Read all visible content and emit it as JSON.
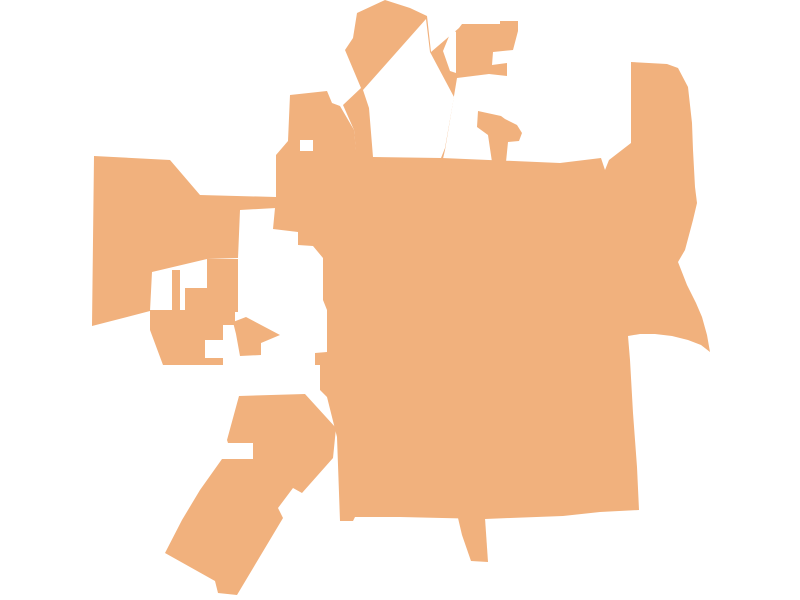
{
  "map": {
    "title": "municipality-boundary-silhouette",
    "background_color": "#ffffff",
    "region_color": "#F1B17D",
    "cutout_color": "#ffffff",
    "width": 800,
    "height": 600,
    "regions": [
      {
        "name": "main-body",
        "points": [
          [
            290,
            95
          ],
          [
            327,
            91
          ],
          [
            332,
            103
          ],
          [
            340,
            106
          ],
          [
            354,
            130
          ],
          [
            356,
            150
          ],
          [
            380,
            158
          ],
          [
            412,
            161
          ],
          [
            442,
            158
          ],
          [
            560,
            163
          ],
          [
            601,
            158
          ],
          [
            605,
            170
          ],
          [
            609,
            160
          ],
          [
            631,
            143
          ],
          [
            631,
            62
          ],
          [
            667,
            64
          ],
          [
            678,
            68
          ],
          [
            688,
            87
          ],
          [
            692,
            123
          ],
          [
            693,
            150
          ],
          [
            695,
            187
          ],
          [
            697,
            203
          ],
          [
            693,
            220
          ],
          [
            685,
            250
          ],
          [
            678,
            262
          ],
          [
            687,
            285
          ],
          [
            696,
            303
          ],
          [
            702,
            317
          ],
          [
            707,
            335
          ],
          [
            710,
            352
          ],
          [
            701,
            345
          ],
          [
            688,
            340
          ],
          [
            672,
            336
          ],
          [
            655,
            334
          ],
          [
            640,
            334
          ],
          [
            628,
            336
          ],
          [
            630,
            360
          ],
          [
            633,
            413
          ],
          [
            637,
            467
          ],
          [
            639,
            510
          ],
          [
            600,
            512
          ],
          [
            563,
            516
          ],
          [
            510,
            518
          ],
          [
            485,
            519
          ],
          [
            400,
            517
          ],
          [
            355,
            517
          ],
          [
            353,
            521
          ],
          [
            340,
            521
          ],
          [
            337,
            437
          ],
          [
            335,
            429
          ],
          [
            327,
            397
          ],
          [
            320,
            390
          ],
          [
            320,
            365
          ],
          [
            315,
            365
          ],
          [
            315,
            353
          ],
          [
            327,
            352
          ],
          [
            327,
            310
          ],
          [
            323,
            300
          ],
          [
            323,
            258
          ],
          [
            313,
            246
          ],
          [
            298,
            245
          ],
          [
            298,
            232
          ],
          [
            273,
            229
          ],
          [
            275,
            208
          ],
          [
            276,
            197
          ],
          [
            276,
            155
          ],
          [
            288,
            141
          ]
        ]
      },
      {
        "name": "north-lobe-assembly",
        "points": [
          [
            345,
            50
          ],
          [
            353,
            38
          ],
          [
            357,
            13
          ],
          [
            385,
            0
          ],
          [
            410,
            8
          ],
          [
            427,
            16
          ],
          [
            431,
            52
          ],
          [
            459,
            28
          ],
          [
            462,
            24
          ],
          [
            500,
            24
          ],
          [
            500,
            21
          ],
          [
            518,
            21
          ],
          [
            518,
            31
          ],
          [
            513,
            50
          ],
          [
            493,
            52
          ],
          [
            492,
            65
          ],
          [
            507,
            63
          ],
          [
            507,
            76
          ],
          [
            489,
            74
          ],
          [
            457,
            78
          ],
          [
            445,
            150
          ],
          [
            442,
            163
          ],
          [
            412,
            163
          ],
          [
            370,
            160
          ],
          [
            356,
            152
          ],
          [
            354,
            130
          ],
          [
            343,
            105
          ],
          [
            361,
            88
          ]
        ]
      },
      {
        "name": "flag-piece",
        "points": [
          [
            478,
            111
          ],
          [
            501,
            116
          ],
          [
            505,
            119
          ],
          [
            517,
            125
          ],
          [
            522,
            133
          ],
          [
            519,
            141
          ],
          [
            508,
            142
          ],
          [
            506,
            162
          ],
          [
            492,
            162
          ],
          [
            488,
            135
          ],
          [
            477,
            127
          ]
        ]
      },
      {
        "name": "west-lobe",
        "points": [
          [
            94,
            156
          ],
          [
            170,
            160
          ],
          [
            200,
            195
          ],
          [
            276,
            197
          ],
          [
            276,
            208
          ],
          [
            240,
            210
          ],
          [
            238,
            258
          ],
          [
            207,
            259
          ],
          [
            152,
            272
          ],
          [
            150,
            311
          ],
          [
            92,
            326
          ]
        ]
      },
      {
        "name": "west-column-a",
        "points": [
          [
            172,
            270
          ],
          [
            180,
            270
          ],
          [
            180,
            312
          ],
          [
            172,
            312
          ]
        ]
      },
      {
        "name": "west-column-b",
        "points": [
          [
            185,
            288
          ],
          [
            207,
            288
          ],
          [
            207,
            312
          ],
          [
            185,
            312
          ]
        ]
      },
      {
        "name": "west-column-c",
        "points": [
          [
            207,
            259
          ],
          [
            238,
            259
          ],
          [
            238,
            312
          ],
          [
            207,
            312
          ]
        ]
      },
      {
        "name": "southwest-chunk",
        "points": [
          [
            150,
            310
          ],
          [
            235,
            310
          ],
          [
            235,
            325
          ],
          [
            223,
            325
          ],
          [
            223,
            340
          ],
          [
            205,
            340
          ],
          [
            205,
            358
          ],
          [
            223,
            358
          ],
          [
            223,
            365
          ],
          [
            163,
            365
          ],
          [
            150,
            330
          ]
        ]
      },
      {
        "name": "arrow-triangle-piece",
        "points": [
          [
            233,
            322
          ],
          [
            246,
            317
          ],
          [
            280,
            335
          ],
          [
            261,
            343
          ],
          [
            261,
            355
          ],
          [
            240,
            356
          ],
          [
            236,
            334
          ]
        ]
      },
      {
        "name": "southwest-lobe",
        "points": [
          [
            239,
            396
          ],
          [
            305,
            394
          ],
          [
            336,
            428
          ],
          [
            333,
            458
          ],
          [
            302,
            493
          ],
          [
            293,
            488
          ],
          [
            278,
            508
          ],
          [
            283,
            518
          ],
          [
            237,
            595
          ],
          [
            218,
            593
          ],
          [
            215,
            581
          ],
          [
            165,
            553
          ],
          [
            182,
            520
          ],
          [
            200,
            490
          ],
          [
            222,
            459
          ],
          [
            253,
            459
          ],
          [
            253,
            443
          ],
          [
            228,
            443
          ],
          [
            227,
            440
          ]
        ]
      },
      {
        "name": "south-tail",
        "points": [
          [
            458,
            518
          ],
          [
            485,
            518
          ],
          [
            488,
            562
          ],
          [
            471,
            561
          ],
          [
            462,
            535
          ]
        ]
      }
    ],
    "cutouts": [
      {
        "name": "north-pocket-hole",
        "points": [
          [
            363,
            90
          ],
          [
            426,
            19
          ],
          [
            430,
            52
          ],
          [
            454,
            97
          ],
          [
            445,
            148
          ],
          [
            441,
            158
          ],
          [
            373,
            157
          ],
          [
            369,
            108
          ]
        ]
      },
      {
        "name": "north-wedge-hole",
        "points": [
          [
            452,
            29
          ],
          [
            443,
            51
          ],
          [
            450,
            71
          ],
          [
            456,
            73
          ],
          [
            456,
            32
          ]
        ]
      },
      {
        "name": "northwest-notch-hole",
        "points": [
          [
            300,
            140
          ],
          [
            313,
            140
          ],
          [
            313,
            151
          ],
          [
            300,
            151
          ]
        ]
      }
    ]
  }
}
